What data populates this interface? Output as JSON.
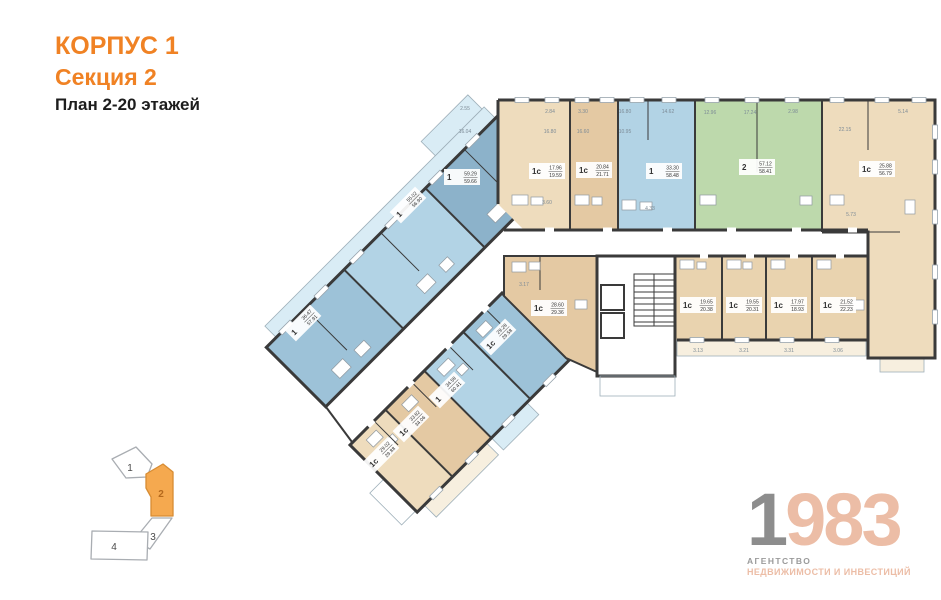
{
  "title": {
    "line1": "КОРПУС 1",
    "line2": "Секция 2",
    "line3": "План 2-20 этажей"
  },
  "theme": {
    "accent": "#f08224",
    "wall": "#3a3a3a",
    "blue_dark": "#8cb2ca",
    "blue_mid": "#9dc2d8",
    "blue_light": "#b2d3e5",
    "balcony_blue": "#d9ecf5",
    "green": "#bdd9ac",
    "tan": "#eedcbd",
    "tan_dark": "#e4c9a3",
    "tan_mid": "#e9d3af",
    "balcony_tan": "#f7efdf",
    "minimap_orange": "#f5a94f",
    "logo_gray": "#8d8d8d",
    "logo_salmon": "#ecbda6",
    "dim_text": "#7d8b96"
  },
  "plan": {
    "apartments": [
      {
        "type": "1",
        "area_top": "36.47",
        "area_bottom": "57.91"
      },
      {
        "type": "1",
        "area_top": "55.02",
        "area_bottom": "56.90"
      },
      {
        "type": "1",
        "area_top": "59.29",
        "area_bottom": "59.66"
      },
      {
        "type": "1с",
        "area_top": "17.96",
        "area_bottom": "19.59"
      },
      {
        "type": "1с",
        "area_top": "20.84",
        "area_bottom": "21.71"
      },
      {
        "type": "1",
        "area_top": "33.30",
        "area_bottom": "58.48"
      },
      {
        "type": "2",
        "area_top": "57.12",
        "area_bottom": "58.41"
      },
      {
        "type": "1с",
        "area_top": "25.88",
        "area_bottom": "56.79"
      },
      {
        "type": "1с",
        "area_top": "19.65",
        "area_bottom": "20.38"
      },
      {
        "type": "1с",
        "area_top": "19.55",
        "area_bottom": "20.31"
      },
      {
        "type": "1с",
        "area_top": "17.97",
        "area_bottom": "18.93"
      },
      {
        "type": "1с",
        "area_top": "21.52",
        "area_bottom": "22.23"
      },
      {
        "type": "1с",
        "area_top": "28.60",
        "area_bottom": "29.36"
      },
      {
        "type": "1с",
        "area_top": "29.28",
        "area_bottom": "29.58"
      },
      {
        "type": "1",
        "area_top": "34.58",
        "area_bottom": "60.41"
      },
      {
        "type": "1с",
        "area_top": "33.82",
        "area_bottom": "34.06"
      },
      {
        "type": "1с",
        "area_top": "29.02",
        "area_bottom": "29.88"
      }
    ],
    "dims": [
      "2.55",
      "2.84",
      "3.30",
      "16.80",
      "14.62",
      "12.96",
      "17.24",
      "2.98",
      "5.14",
      "16.04",
      "16.80",
      "16.60",
      "10.95",
      "22.15",
      "5.73",
      "4.33",
      "3.60",
      "3.17",
      "3.13",
      "3.21",
      "3.31",
      "3.06"
    ]
  },
  "minimap": {
    "sections": [
      {
        "label": "1"
      },
      {
        "label": "2"
      },
      {
        "label": "3"
      },
      {
        "label": "4"
      }
    ],
    "active": "2"
  },
  "logo": {
    "digit_gray": "1",
    "digits_salmon": "983",
    "caption_line1": "АГЕНТСТВО",
    "caption_line2": "НЕДВИЖИМОСТИ И ИНВЕСТИЦИЙ"
  }
}
